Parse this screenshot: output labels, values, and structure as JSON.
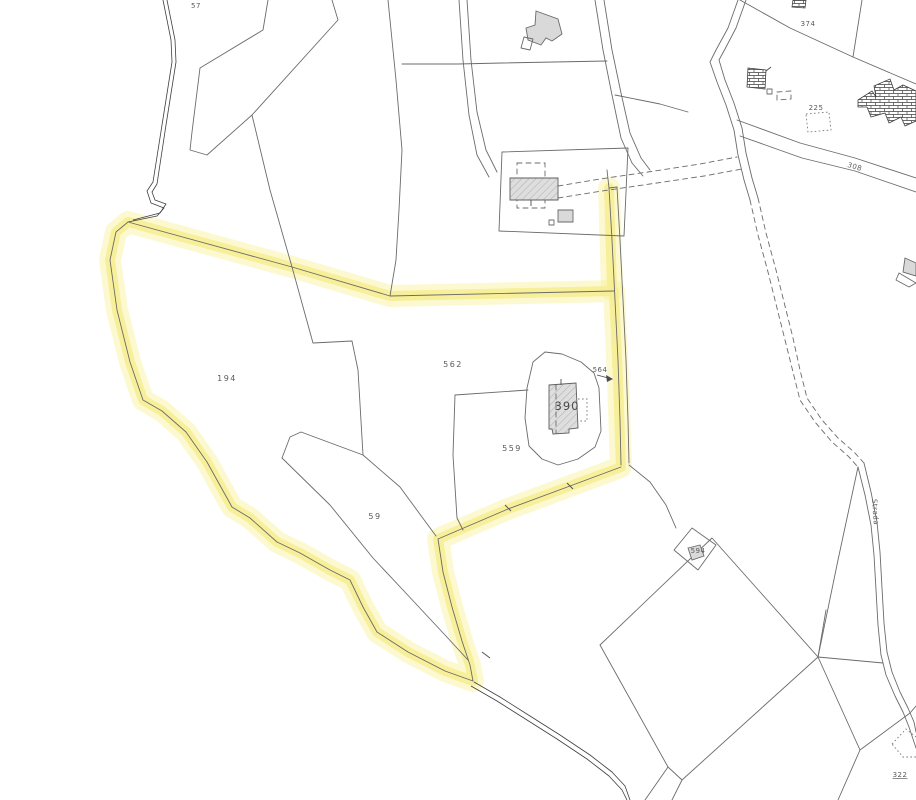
{
  "map": {
    "kind": "cadastral-parcel-map",
    "background_color": "#ffffff",
    "highlight_color": "#f6ee94",
    "parcel_line_color": "#6b6b6b",
    "building_fill_color": "#d9d9d9",
    "selected_parcel_labels": [
      "194",
      "562",
      "59",
      "559",
      "564"
    ],
    "labels": {
      "p57": "57",
      "p194": "194",
      "p562": "562",
      "p559": "559",
      "p59": "59",
      "p390": "390",
      "p564": "564",
      "p594": "594",
      "p374": "374",
      "p225": "225",
      "p322": "322",
      "r308": "308",
      "road_name": "Strada"
    }
  }
}
